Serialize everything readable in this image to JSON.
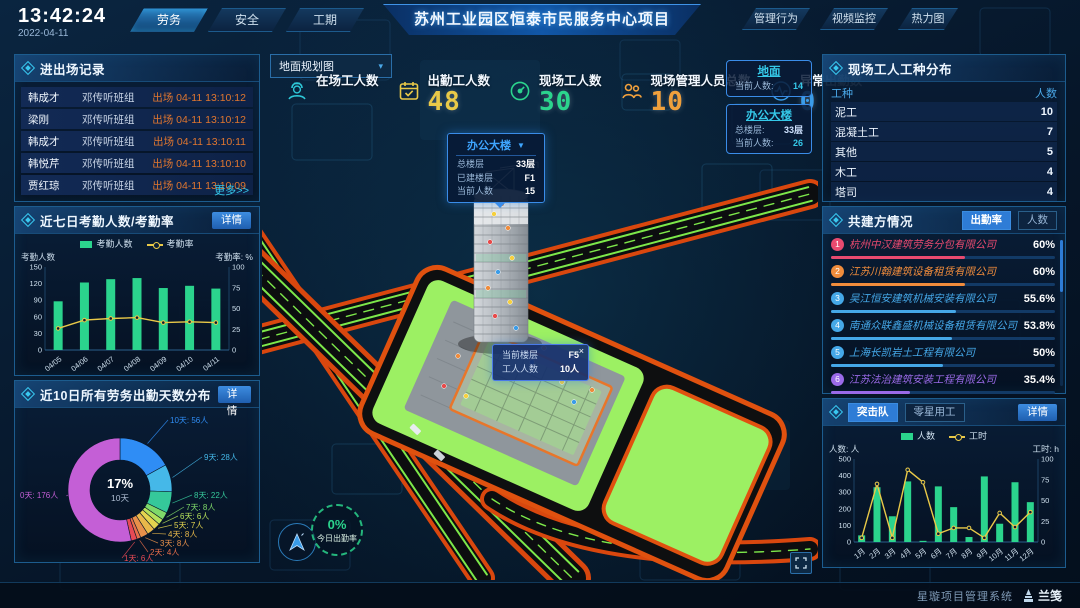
{
  "header": {
    "time": "13:42:24",
    "date": "2022-04-11",
    "nav_left": [
      {
        "label": "劳务",
        "active": true
      },
      {
        "label": "安全",
        "active": false
      },
      {
        "label": "工期",
        "active": false
      }
    ],
    "title": "苏州工业园区恒泰市民服务中心项目",
    "nav_right": [
      {
        "label": "管理行为"
      },
      {
        "label": "视频监控"
      },
      {
        "label": "热力图"
      }
    ]
  },
  "records": {
    "title": "进出场记录",
    "more": "更多>>",
    "rows": [
      {
        "name": "韩成才",
        "team": "邓传听班组",
        "event": "出场 04-11 13:10:12"
      },
      {
        "name": "梁刚",
        "team": "邓传听班组",
        "event": "出场 04-11 13:10:12"
      },
      {
        "name": "韩成才",
        "team": "邓传听班组",
        "event": "出场 04-11 13:10:11"
      },
      {
        "name": "韩悦芹",
        "team": "邓传听班组",
        "event": "出场 04-11 13:10:10"
      },
      {
        "name": "贾红琼",
        "team": "邓传听班组",
        "event": "出场 04-11 13:10:09"
      }
    ]
  },
  "attendance": {
    "title": "近七日考勤人数/考勤率",
    "detail": "详情",
    "legend": [
      "考勤人数",
      "考勤率"
    ],
    "axis_left": "考勤人数",
    "axis_right": "考勤率:  %"
  },
  "distribution": {
    "title": "近10日所有劳务出勤天数分布",
    "detail": "详情",
    "center_value": "17%",
    "center_label": "10天"
  },
  "map": {
    "view_select": "地面规划图",
    "view_caret": "▾",
    "stats": [
      {
        "label": "在场工人数",
        "value": ""
      },
      {
        "label": "出勤工人数",
        "value": "48",
        "color": "#e9c948"
      },
      {
        "label": "现场工人数",
        "value": "30",
        "color": "#2bd48d"
      },
      {
        "label": "现场管理人员总数",
        "value": "10",
        "color": "#f0a03c"
      },
      {
        "label": "异常出勤数",
        "value": "0",
        "color": "#3a9ce8"
      }
    ],
    "building_tooltip": {
      "title": "办公大楼",
      "caret": "▼",
      "rows": [
        {
          "label": "总楼层",
          "value": "33层"
        },
        {
          "label": "已建楼层",
          "value": "F1"
        },
        {
          "label": "当前人数",
          "value": "15"
        }
      ]
    },
    "zone_ground": {
      "title": "地面",
      "rows": [
        {
          "label": "当前人数:",
          "value": "14"
        }
      ]
    },
    "zone_building": {
      "title": "办公大楼",
      "rows": [
        {
          "label": "总楼层:",
          "value": "33层"
        },
        {
          "label": "当前人数:",
          "value": "26"
        }
      ]
    },
    "floor_tooltip": {
      "close": "×",
      "rows": [
        {
          "label": "当前楼层",
          "value": "F5"
        },
        {
          "label": "工人人数",
          "value": "10人"
        }
      ]
    },
    "today_rate": {
      "value": "0%",
      "label": "今日出勤率"
    }
  },
  "worker_types": {
    "title": "现场工人工种分布",
    "headers": [
      "工种",
      "人数"
    ],
    "rows": [
      [
        "泥工",
        "10"
      ],
      [
        "混凝土工",
        "7"
      ],
      [
        "其他",
        "5"
      ],
      [
        "木工",
        "4"
      ],
      [
        "塔司",
        "4"
      ]
    ]
  },
  "partners": {
    "title": "共建方情况",
    "tabs": [
      {
        "label": "出勤率",
        "active": true
      },
      {
        "label": "人数",
        "active": false
      }
    ],
    "companies": [
      {
        "rank": "1",
        "name": "杭州中汉建筑劳务分包有限公司",
        "percent": "60%",
        "color": "#e84a6f"
      },
      {
        "rank": "2",
        "name": "江苏川翰建筑设备租赁有限公司",
        "percent": "60%",
        "color": "#f08c3c"
      },
      {
        "rank": "3",
        "name": "吴江恒安建筑机械安装有限公司",
        "percent": "55.6%",
        "color": "#45a8e8"
      },
      {
        "rank": "4",
        "name": "南通众联鑫盛机械设备租赁有限公司",
        "percent": "53.8%",
        "color": "#45a8e8"
      },
      {
        "rank": "5",
        "name": "上海长凯岩土工程有限公司",
        "percent": "50%",
        "color": "#45a8e8"
      },
      {
        "rank": "6",
        "name": "江苏法治建筑安装工程有限公司",
        "percent": "35.4%",
        "color": "#9a6ae8"
      }
    ]
  },
  "surge": {
    "tabs": [
      {
        "label": "突击队",
        "active": true
      },
      {
        "label": "零星用工",
        "active": false
      }
    ],
    "detail": "详情",
    "legend": [
      "人数",
      "工时"
    ],
    "axis_left": "人数: 人",
    "axis_right": "工时:  h"
  },
  "footer": {
    "system": "星璇项目管理系统",
    "logo": "兰笺"
  },
  "chart_data": [
    {
      "id": "attendance7",
      "type": "bar",
      "title": "近七日考勤人数/考勤率",
      "categories": [
        "04/05",
        "04/06",
        "04/07",
        "04/08",
        "04/09",
        "04/10",
        "04/11"
      ],
      "series": [
        {
          "name": "考勤人数",
          "type": "bar",
          "axis": "left",
          "color": "#2bd48d",
          "values": [
            88,
            122,
            128,
            130,
            112,
            116,
            111
          ]
        },
        {
          "name": "考勤率",
          "type": "line",
          "axis": "right",
          "color": "#e9c948",
          "values": [
            26,
            36,
            38,
            39,
            33,
            34,
            33
          ]
        }
      ],
      "xlabel": "",
      "ylabel": "考勤人数",
      "ylabel_right": "考勤率: %",
      "ylim_left": [
        0,
        150
      ],
      "ylim_right": [
        0,
        100
      ],
      "grid": false,
      "legend_position": "top"
    },
    {
      "id": "attendance_days_donut",
      "type": "pie",
      "title": "近10日所有劳务出勤天数分布",
      "center": {
        "value": "17%",
        "label": "10天"
      },
      "slices": [
        {
          "label": "10天",
          "value": 56,
          "display": "10天:  56人",
          "color": "#2f8df5"
        },
        {
          "label": "9天",
          "value": 28,
          "display": "9天:  28人",
          "color": "#45b8e8"
        },
        {
          "label": "8天",
          "value": 22,
          "display": "8天:  22人",
          "color": "#35c89a"
        },
        {
          "label": "7天",
          "value": 8,
          "display": "7天:  8人",
          "color": "#7ed96a"
        },
        {
          "label": "6天",
          "value": 6,
          "display": "6天:  6人",
          "color": "#b5e05a"
        },
        {
          "label": "5天",
          "value": 7,
          "display": "5天:  7人",
          "color": "#e3d44f"
        },
        {
          "label": "4天",
          "value": 8,
          "display": "4天:  8人",
          "color": "#e8b84a"
        },
        {
          "label": "3天",
          "value": 8,
          "display": "3天:  8人",
          "color": "#e8904a"
        },
        {
          "label": "2天",
          "value": 4,
          "display": "2天:  4人",
          "color": "#e86e4a"
        },
        {
          "label": "1天",
          "value": 6,
          "display": "1天:  6人",
          "color": "#e84a55"
        },
        {
          "label": "0天",
          "value": 176,
          "display": "0天:  176人",
          "color": "#c45fd6"
        }
      ]
    },
    {
      "id": "surge_monthly",
      "type": "bar",
      "title": "突击队",
      "categories": [
        "1月",
        "2月",
        "3月",
        "4月",
        "5月",
        "6月",
        "7月",
        "8月",
        "9月",
        "10月",
        "11月",
        "12月"
      ],
      "series": [
        {
          "name": "人数",
          "type": "bar",
          "axis": "left",
          "color": "#2bd48d",
          "values": [
            40,
            330,
            155,
            365,
            7,
            335,
            210,
            30,
            395,
            110,
            360,
            240
          ]
        },
        {
          "name": "工时",
          "type": "line",
          "axis": "right",
          "color": "#e9c948",
          "values": [
            5,
            70,
            5,
            87,
            72,
            10,
            17,
            17,
            5,
            35,
            18,
            36
          ]
        }
      ],
      "xlabel": "",
      "ylabel": "人数: 人",
      "ylabel_right": "工时: h",
      "ylim_left": [
        0,
        500
      ],
      "ylim_right": [
        0,
        100
      ],
      "grid": false,
      "legend_position": "top"
    }
  ]
}
